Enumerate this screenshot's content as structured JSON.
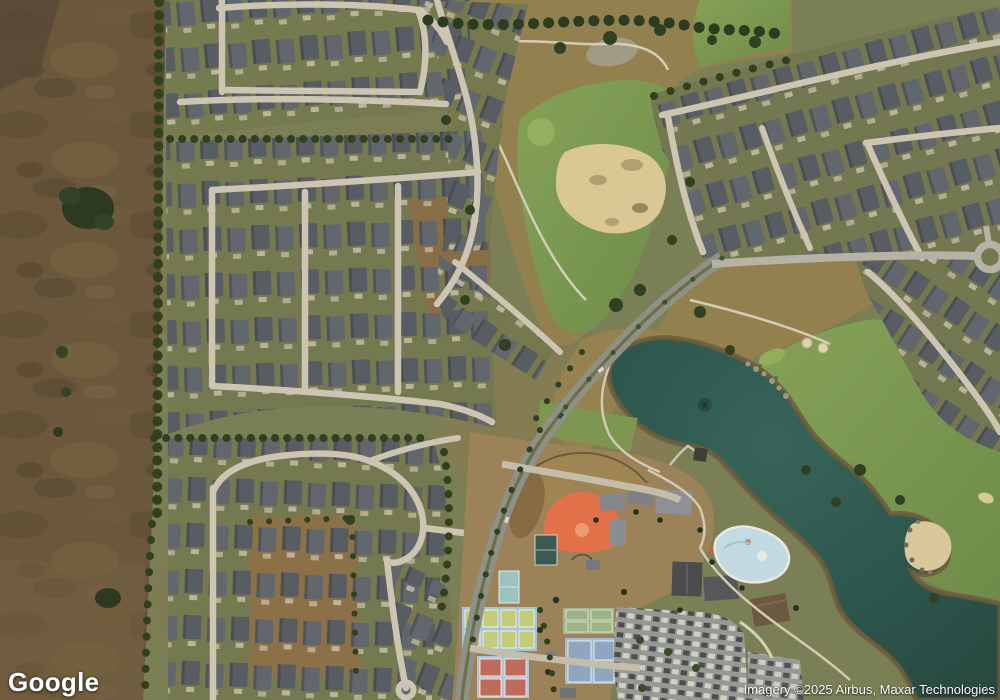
{
  "map": {
    "view": "satellite",
    "provider": "Google"
  },
  "logo": {
    "text": "Google"
  },
  "attribution": {
    "text": "Imagery ©2025 Airbus, Maxar Technologies"
  },
  "palette": {
    "lake_water": "#2e574d",
    "farmland": "#6b583c",
    "fairway_green": "#7d9750",
    "golf_rough": "#93804f",
    "house_roof": "#5a5e64",
    "residential_street": "#cbc5b2",
    "main_road": "#8f9086",
    "sand_bunker": "#d9c794",
    "infield_clay": "#e2714a",
    "pool_water": "#c2dbe3",
    "pickleball_court": "#a9c3d2",
    "tennis_court": "#3d5a52",
    "tree_canopy": "#31411f"
  }
}
